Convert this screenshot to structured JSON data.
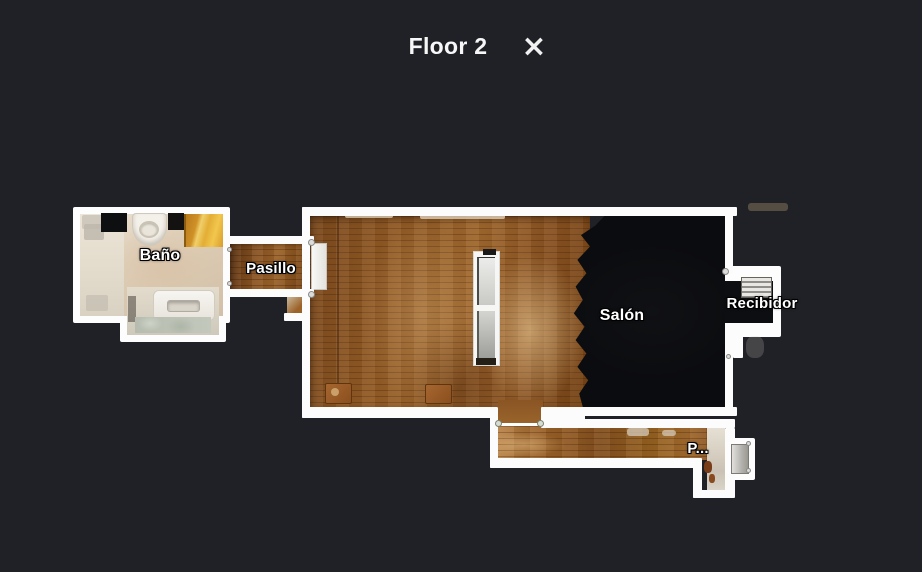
{
  "header": {
    "title": "Floor 2",
    "close_icon": "×"
  },
  "floorplan": {
    "rooms": {
      "bano": {
        "label": "Baño"
      },
      "pasillo": {
        "label": "Pasillo"
      },
      "salon": {
        "label": "Salón"
      },
      "recibidor": {
        "label": "Recibidor"
      },
      "pasillo_inferior": {
        "label": "P..."
      }
    },
    "colors": {
      "background": "#1f2126",
      "wall": "#ffffff",
      "wood": "#8a5526",
      "wood_light": "#c99a55",
      "bathroom_tile": "#ddcfbc",
      "bath_mat": "#e0a93c",
      "unscanned_floor": "#0b0c0e"
    }
  }
}
